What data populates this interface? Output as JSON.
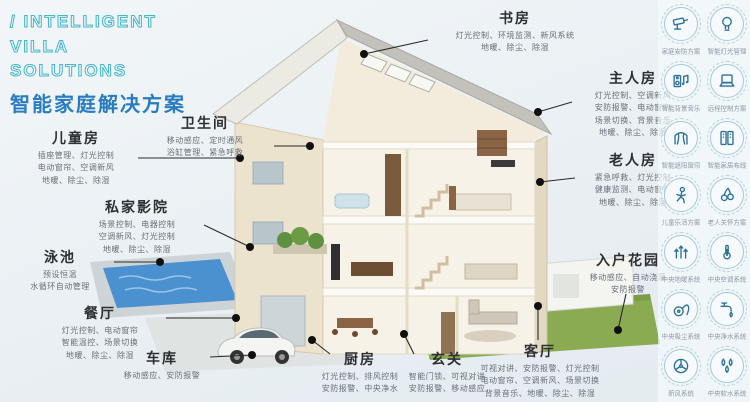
{
  "title": {
    "en_line1": "/ INTELLIGENT",
    "en_line2": "VILLA",
    "en_line3": "SOLUTIONS",
    "cn": "智能家庭解决方案"
  },
  "colors": {
    "accent_teal": "#45b7c9",
    "accent_blue": "#2a7cc0",
    "heading_text": "#2d2f31",
    "feature_text": "#676f78",
    "icon_blue": "#2e7396",
    "callout_dot": "#101010",
    "pool_blue": "#4b90cf",
    "lawn_green": "#8aab52",
    "wall_cream": "#ece3cf"
  },
  "rooms": [
    {
      "name": "儿童房",
      "features": [
        "插座管理、灯光控制",
        "电动窗帘、空调新风",
        "地暖、除尘、除湿"
      ]
    },
    {
      "name": "卫生间",
      "features": [
        "移动感应、定时通风",
        "浴缸管理、紧急呼救"
      ]
    },
    {
      "name": "私家影院",
      "features": [
        "场景控制、电器控制",
        "空调新风、灯光控制",
        "地暖、除尘、除湿"
      ]
    },
    {
      "name": "泳池",
      "features": [
        "预设恒温",
        "水循环自动管理"
      ]
    },
    {
      "name": "餐厅",
      "features": [
        "灯光控制、电动窗帘",
        "智能温控、场景切换",
        "地暖、除尘、除湿"
      ]
    },
    {
      "name": "车库",
      "features": [
        "移动感应、安防报警"
      ]
    },
    {
      "name": "厨房",
      "features": [
        "灯光控制、排风控制",
        "安防报警、中央净水"
      ]
    },
    {
      "name": "玄关",
      "features": [
        "智能门锁、可视对讲",
        "安防报警、移动感应"
      ]
    },
    {
      "name": "客厅",
      "features": [
        "可视对讲、安防报警、灯光控制",
        "电动窗帘、空调新风、场景切换",
        "背景音乐、地暖、除尘、除湿"
      ]
    },
    {
      "name": "书房",
      "features": [
        "灯光控制、环境监测、新风系统",
        "地暖、除尘、除湿"
      ]
    },
    {
      "name": "主人房",
      "features": [
        "灯光控制、空调新风",
        "安防报警、电动窗帘",
        "场景切换、背景音乐",
        "地暖、除尘、除湿"
      ]
    },
    {
      "name": "老人房",
      "features": [
        "紧急呼救、灯光控制",
        "健康监测、电动窗帘",
        "地暖、除尘、除湿"
      ]
    },
    {
      "name": "入户花园",
      "features": [
        "移动感应、自动浇灌",
        "安防报警"
      ]
    }
  ],
  "icon_panel": {
    "items": [
      {
        "icon": "camera",
        "label": "家庭安防方案"
      },
      {
        "icon": "bulb",
        "label": "智能灯光管理"
      },
      {
        "icon": "av",
        "label": "智能背景音乐"
      },
      {
        "icon": "laptop",
        "label": "远程控制方案"
      },
      {
        "icon": "curtain",
        "label": "智能遮阳窗帘"
      },
      {
        "icon": "rack",
        "label": "智能家居布线"
      },
      {
        "icon": "child",
        "label": "儿童乐活方案"
      },
      {
        "icon": "care",
        "label": "老人关怀方案"
      },
      {
        "icon": "arrows",
        "label": "中央地暖系统"
      },
      {
        "icon": "thermo",
        "label": "中央空调系统"
      },
      {
        "icon": "vacuum",
        "label": "中央吸尘系统"
      },
      {
        "icon": "purifier",
        "label": "中央净水系统"
      },
      {
        "icon": "fan",
        "label": "新风系统"
      },
      {
        "icon": "drops",
        "label": "中央软水系统"
      }
    ]
  }
}
